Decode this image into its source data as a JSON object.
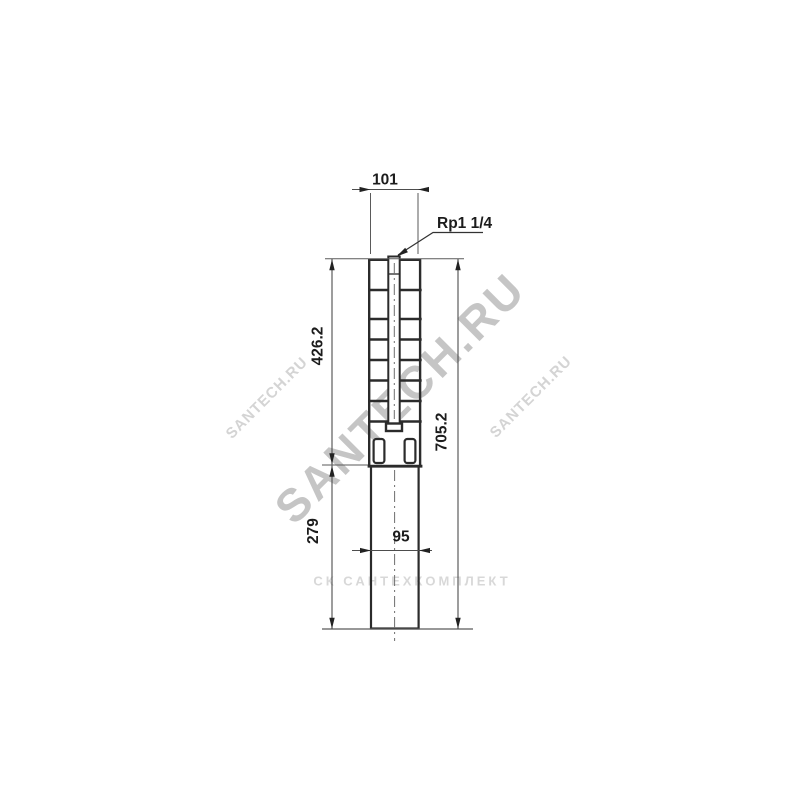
{
  "drawing": {
    "subject": "Submersible borehole pump dimensional drawing",
    "dims": {
      "top_width": "101",
      "connection": "Rp1 1/4",
      "upper_height": "426.2",
      "total_height": "705.2",
      "lower_height": "279",
      "lower_width": "95"
    }
  },
  "watermarks": {
    "main": "SANTECH.RU",
    "left": "SANTECH.RU",
    "right": "SANTECH.RU",
    "bottom": "СК САНТЕХКОМПЛЕКТ"
  },
  "colors": {
    "background": "#ffffff",
    "outline": "#2b2b2b",
    "dimension_line": "#4d4d4d",
    "extension_line": "#5a5a5a",
    "centerline": "#6e6e6e",
    "text": "#1c1c1c",
    "watermark_main": "#9e9e9e",
    "watermark_light": "#d6d6d6"
  }
}
